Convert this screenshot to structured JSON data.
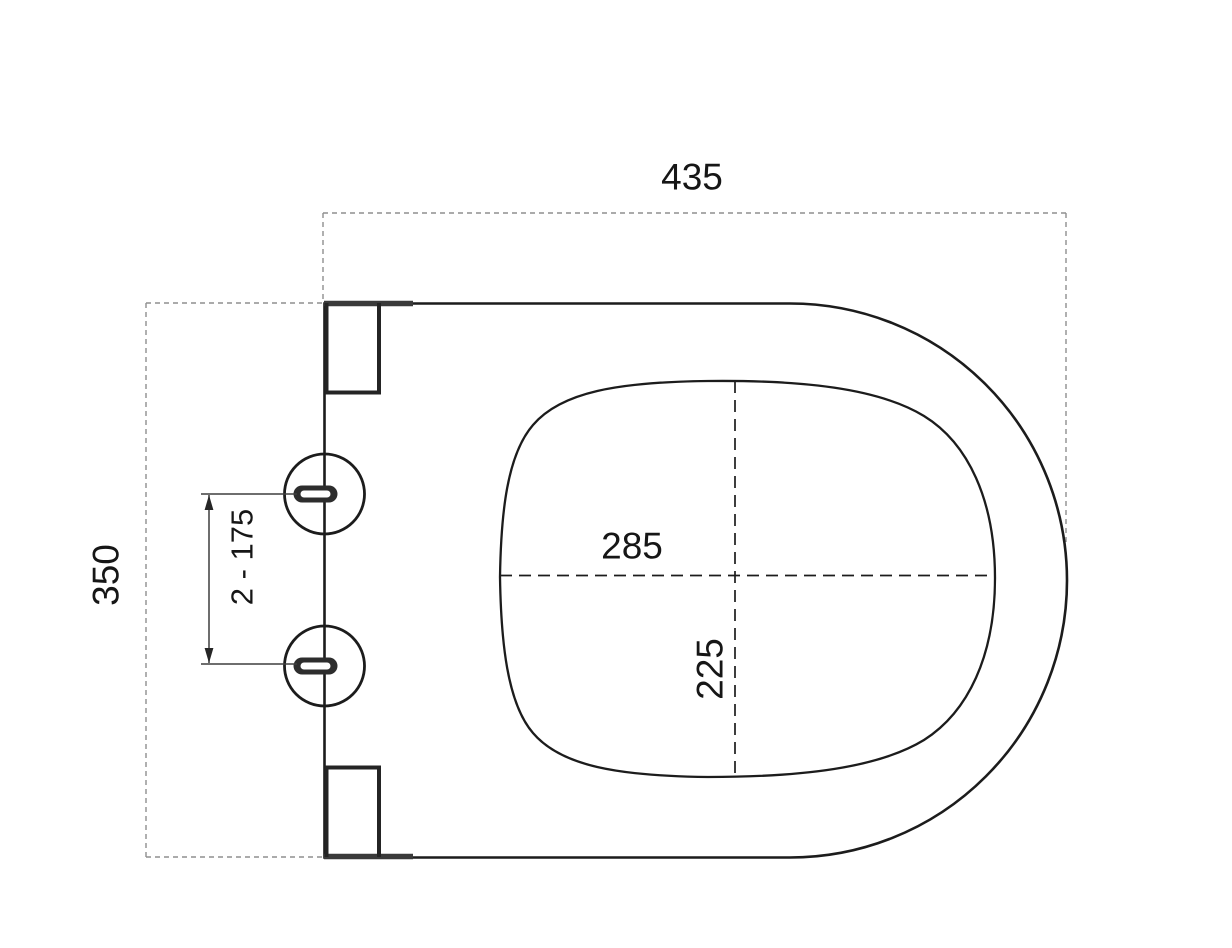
{
  "page": {
    "background": "#ffffff"
  },
  "drawing": {
    "description": "Technical dimension drawing of a toilet seat, top view, with hinge mounting holes",
    "colors": {
      "line": "#1c1c1c",
      "dimension_dashed": "#8f8f8f",
      "slot_fill": "#2d2d2d",
      "background": "#ffffff"
    },
    "dimensions": {
      "overall_width": "435",
      "overall_depth": "350",
      "bowl_opening_width": "285",
      "bowl_opening_depth": "225",
      "hinge_hole_spacing": "2 - 175"
    }
  }
}
